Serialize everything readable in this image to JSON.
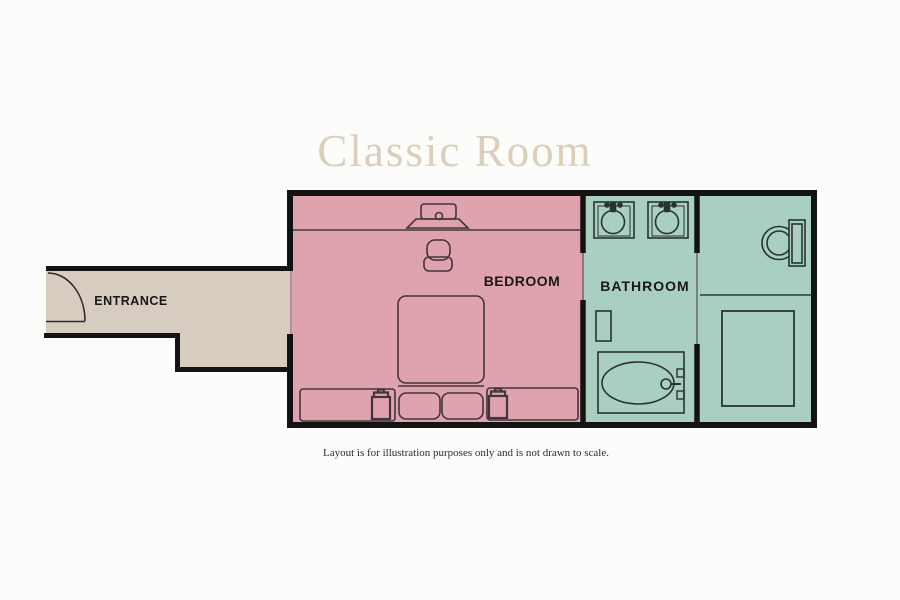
{
  "title": "Classic Room",
  "rooms": {
    "entrance": {
      "label": "ENTRANCE"
    },
    "bedroom": {
      "label": "BEDROOM"
    },
    "bathroom": {
      "label": "BATHROOM"
    }
  },
  "disclaimer": "Layout is for illustration purposes only and is not drawn to scale.",
  "colors": {
    "bedroom_fill": "#dfa3ad",
    "bathroom_fill": "#a8cfc0",
    "entrance_fill": "#d6cdc0",
    "wall": "#131313",
    "title_text": "#dbceba",
    "label_text": "#181818"
  },
  "furniture": [
    "door-swing",
    "tv",
    "armchair",
    "double-bed",
    "pillows",
    "bench",
    "bedside-lamp",
    "sink",
    "sink",
    "shelf",
    "bathtub",
    "toilet",
    "shower"
  ]
}
